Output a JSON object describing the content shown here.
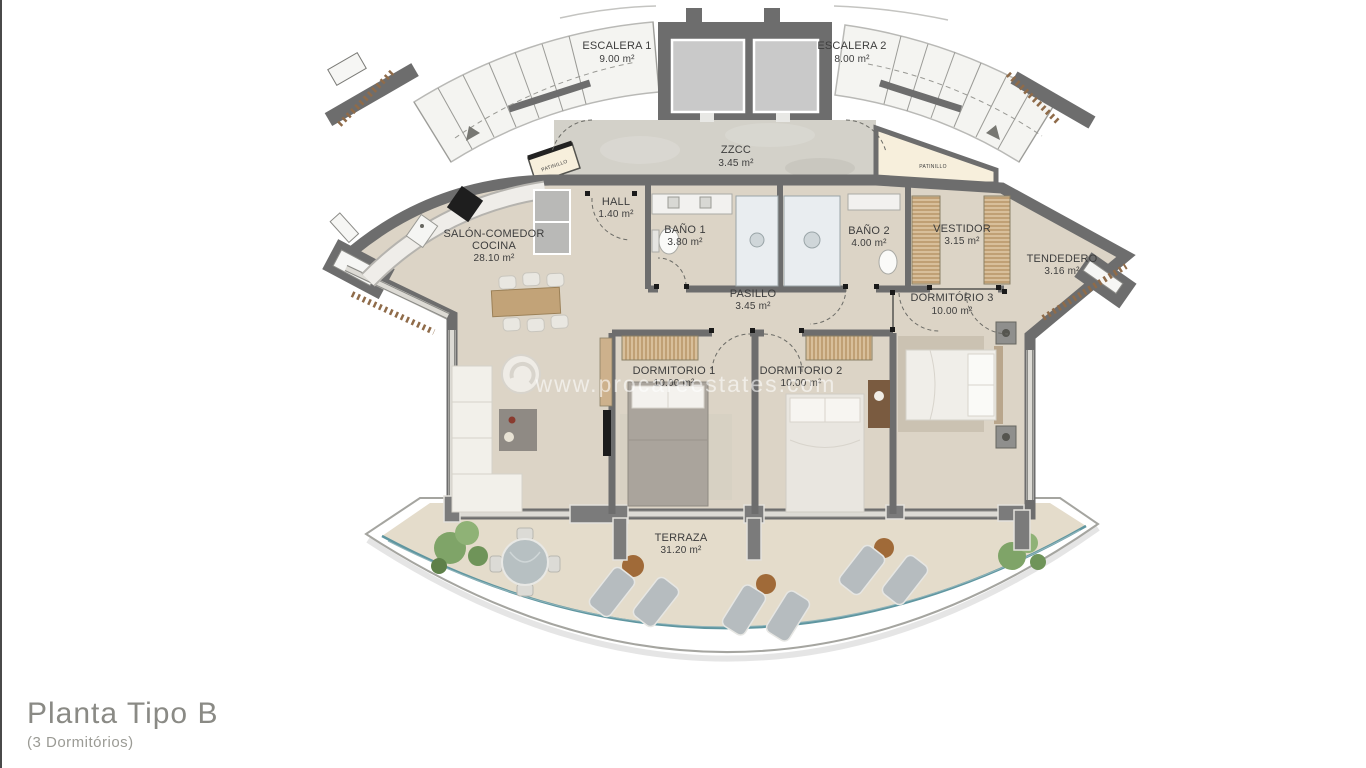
{
  "colors": {
    "wall": "#6d6d6d",
    "floor": "#dcd4c6",
    "terrace_floor": "#e4dccb",
    "zzcc_floor": "#d3d1c9",
    "stair_floor": "#f4f4f1",
    "core_cell": "#c9c9c9",
    "patinillo": "#f7efdc",
    "railing": "#5f96a0",
    "louver": "#8f6b49",
    "wood": "#c2a378",
    "wardrobe": "#d8bf9b",
    "plant": "#7fa468",
    "label_text": "#3d3d3d",
    "title_text": "#8a8a85"
  },
  "watermark": {
    "text": "www.procareestates.com"
  },
  "title_block": {
    "title": "Planta Tipo B",
    "subtitle": "(3 Dormitórios)"
  },
  "rooms": {
    "escalera1": {
      "name": "ESCALERA 1",
      "area": "9.00 m²"
    },
    "escalera2": {
      "name": "ESCALERA 2",
      "area": "8.00 m²"
    },
    "zzcc": {
      "name": "ZZCC",
      "area": "3.45 m²"
    },
    "patinillo_left": {
      "name": "PATINILLO"
    },
    "patinillo_right": {
      "name": "PATINILLO"
    },
    "hall": {
      "name": "HALL",
      "area": "1.40 m²"
    },
    "salon": {
      "name": "SALÓN-COMEDOR",
      "name2": "COCINA",
      "area": "28.10 m²"
    },
    "bano1": {
      "name": "BAÑO 1",
      "area": "3.80 m²"
    },
    "bano2": {
      "name": "BAÑO 2",
      "area": "4.00 m²"
    },
    "vestidor": {
      "name": "VESTIDOR",
      "area": "3.15 m²"
    },
    "tendedero": {
      "name": "TENDEDERO",
      "area": "3.16 m²"
    },
    "pasillo": {
      "name": "PASILLO",
      "area": "3.45 m²"
    },
    "dormitorio1": {
      "name": "DORMITORIO 1",
      "area": "10.00 m²"
    },
    "dormitorio2": {
      "name": "DORMITORIO 2",
      "area": "10.00 m²"
    },
    "dormitorio3": {
      "name": "DORMITÓRIO 3",
      "area": "10.00 m²"
    },
    "terraza": {
      "name": "TERRAZA",
      "area": "31.20 m²"
    }
  }
}
